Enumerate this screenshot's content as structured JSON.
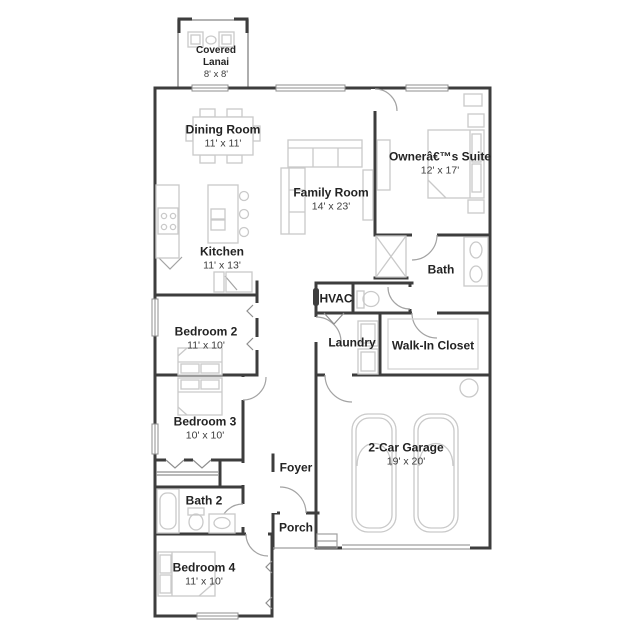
{
  "plan": {
    "type": "single-story floor plan",
    "colors": {
      "wall": "#3d3d3d",
      "furniture": "#c9c9c9",
      "door_arc": "#a3a3a3",
      "window_frame": "#8f8f8f",
      "room_text": "#232323",
      "dims_text": "#3d3d3d",
      "background": "#ffffff"
    },
    "rooms": [
      {
        "id": "covered-lanai",
        "name": "Covered Lanai",
        "dims": "8' x 8'"
      },
      {
        "id": "dining-room",
        "name": "Dining Room",
        "dims": "11' x 11'"
      },
      {
        "id": "family-room",
        "name": "Family Room",
        "dims": "14' x 23'"
      },
      {
        "id": "owners-suite",
        "name": "Ownerâ€™s Suite",
        "dims": "12' x 17'"
      },
      {
        "id": "kitchen",
        "name": "Kitchen",
        "dims": "11' x 13'"
      },
      {
        "id": "bath",
        "name": "Bath"
      },
      {
        "id": "hvac",
        "name": "HVAC"
      },
      {
        "id": "bedroom-2",
        "name": "Bedroom 2",
        "dims": "11' x 10'"
      },
      {
        "id": "laundry",
        "name": "Laundry"
      },
      {
        "id": "walk-in-closet",
        "name": "Walk-In Closet"
      },
      {
        "id": "bedroom-3",
        "name": "Bedroom 3",
        "dims": "10' x 10'"
      },
      {
        "id": "foyer",
        "name": "Foyer"
      },
      {
        "id": "garage",
        "name": "2-Car Garage",
        "dims": "19' x 20'"
      },
      {
        "id": "bath-2",
        "name": "Bath 2"
      },
      {
        "id": "porch",
        "name": "Porch"
      },
      {
        "id": "bedroom-4",
        "name": "Bedroom 4",
        "dims": "11' x 10'"
      }
    ]
  }
}
